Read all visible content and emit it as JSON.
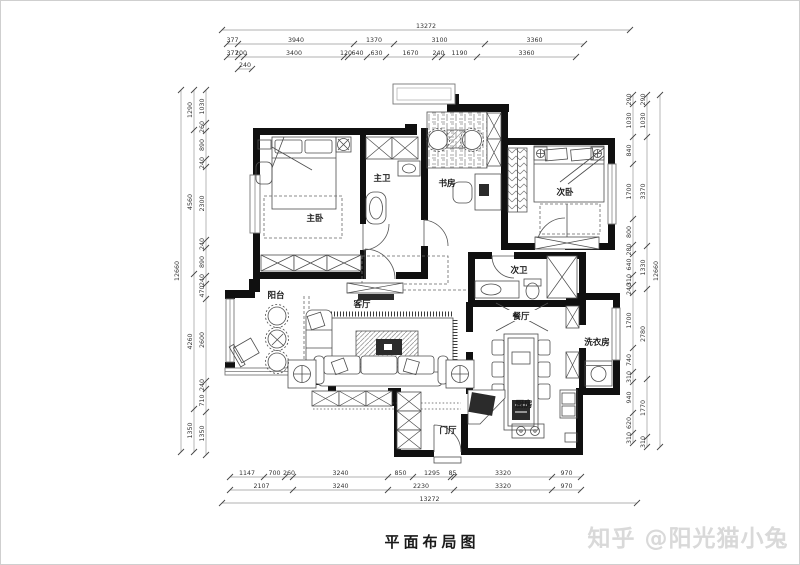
{
  "title": "平面布局图",
  "watermark": {
    "text": "知乎 @阳光猫小兔"
  },
  "rooms": {
    "master_bedroom": "主卧",
    "master_bath": "主卫",
    "study": "书房",
    "second_bedroom": "次卧",
    "second_bath": "次卫",
    "living_room": "客厅",
    "balcony": "阳台",
    "dining_room": "餐厅",
    "laundry_room": "洗衣房",
    "kitchen": "厨房",
    "foyer": "门厅"
  },
  "dimensions": {
    "top_total": [
      "13272"
    ],
    "top_row1": [
      "377",
      "3940",
      "1370",
      "3100",
      "3360"
    ],
    "top_row2": [
      "377",
      "200",
      "3400",
      "120",
      "640",
      "630",
      "1670",
      "240",
      "1190",
      "3360"
    ],
    "top_row3": [
      "240"
    ],
    "bottom_row1": [
      "1147",
      "700",
      "260",
      "3240",
      "850",
      "1295",
      "85",
      "3320",
      "970"
    ],
    "bottom_row2": [
      "2107",
      "3240",
      "2230",
      "3320",
      "970"
    ],
    "bottom_total": [
      "13272"
    ],
    "left_total": [
      "12660"
    ],
    "left_outer": [
      "1290",
      "4560",
      "4260",
      "1350"
    ],
    "left_inner": [
      "1030",
      "260",
      "890",
      "240",
      "2300",
      "240",
      "890",
      "240",
      "470",
      "2600",
      "240",
      "710",
      "1350"
    ],
    "right_total": [
      "12660"
    ],
    "right_outer": [
      "290",
      "1030",
      "3370",
      "1330",
      "2780",
      "1770",
      "310"
    ],
    "right_inner": [
      "290",
      "1030",
      "840",
      "1700",
      "800",
      "280",
      "640",
      "310",
      "240",
      "1700",
      "740",
      "310",
      "940",
      "620",
      "310"
    ]
  }
}
